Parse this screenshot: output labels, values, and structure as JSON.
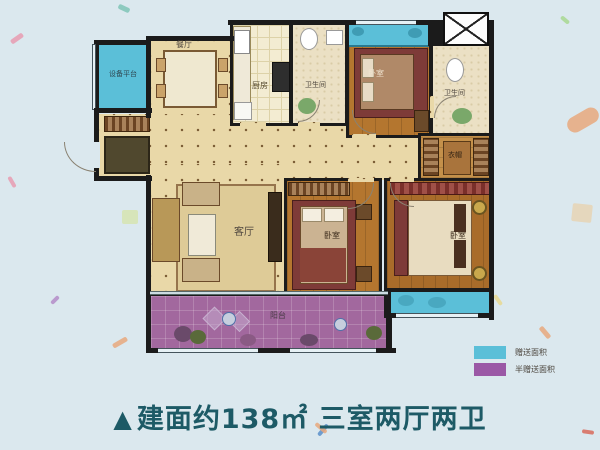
{
  "colors": {
    "background": "#dbe8ee",
    "wall": "#1b1b1b",
    "floor": "#e9d8a8",
    "wood": "#b4762f",
    "gift_area": "#5bbfd8",
    "half_gift_area": "#9b58a6",
    "caption_text": "#1d5a66"
  },
  "rooms": {
    "equipment_platform": {
      "label": "设备平台"
    },
    "dining": {
      "label": "餐厅"
    },
    "kitchen": {
      "label": "厨房"
    },
    "bath_top": {
      "label": "卫生间"
    },
    "bedroom_top": {
      "label": "卧室"
    },
    "bath_right": {
      "label": "卫生间"
    },
    "cloakroom": {
      "label": "衣帽"
    },
    "living": {
      "label": "客厅"
    },
    "bedroom_mid": {
      "label": "卧室"
    },
    "bedroom_master": {
      "label": "卧室"
    },
    "balcony": {
      "label": "阳台"
    }
  },
  "legend": {
    "items": [
      {
        "label": "赠送面积",
        "color": "#5bbfd8"
      },
      {
        "label": "半赠送面积",
        "color": "#9b58a6"
      }
    ]
  },
  "caption": {
    "marker": "▲",
    "text": "建面约138㎡ 三室两厅两卫"
  }
}
